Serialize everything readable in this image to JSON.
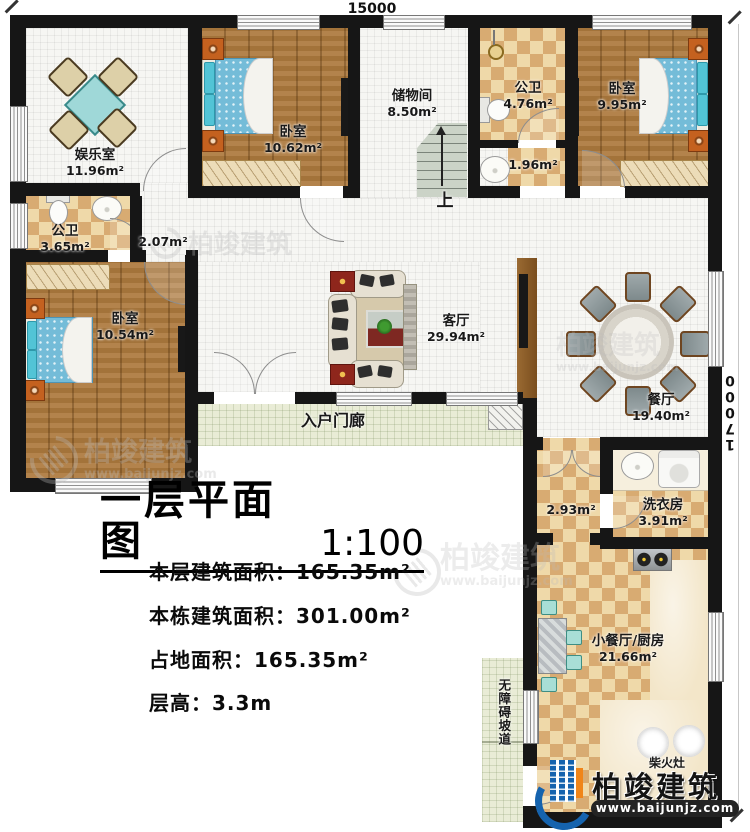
{
  "dimensions": {
    "top": "15000",
    "right": "17000"
  },
  "rooms": {
    "entertainment": {
      "name": "娱乐室",
      "area": "11.96m²"
    },
    "bedroom_a": {
      "name": "卧室",
      "area": "10.62m²"
    },
    "bath_left": {
      "name": "公卫",
      "area": "3.65m²"
    },
    "hall": {
      "area": "2.07m²"
    },
    "storage": {
      "name": "储物间",
      "area": "8.50m²"
    },
    "bath_top": {
      "name": "公卫",
      "area": "4.76m²"
    },
    "wash_nook": {
      "area": "1.96m²"
    },
    "bedroom_b": {
      "name": "卧室",
      "area": "9.95m²"
    },
    "bedroom_c": {
      "name": "卧室",
      "area": "10.54m²"
    },
    "living": {
      "name": "客厅",
      "area": "29.94m²"
    },
    "dining": {
      "name": "餐厅",
      "area": "19.40m²"
    },
    "porch": {
      "name": "入户门廊"
    },
    "corridor": {
      "area": "2.93m²"
    },
    "laundry": {
      "name": "洗衣房",
      "area": "3.91m²"
    },
    "kitchen": {
      "name": "小餐厅/厨房",
      "area": "21.66m²"
    },
    "ramp": {
      "name": "无障碍坡道"
    },
    "wood_stove": {
      "name": "柴火灶"
    },
    "stairs": {
      "direction": "上"
    }
  },
  "title_block": {
    "title": "一层平面图",
    "scale": "1:100",
    "stats": [
      {
        "label": "本层建筑面积：",
        "value": "165.35m²"
      },
      {
        "label": "本栋建筑面积：",
        "value": "301.00m²"
      },
      {
        "label": "占地面积：",
        "value": "165.35m²"
      },
      {
        "label": "层高：",
        "value": "3.3m"
      }
    ]
  },
  "watermark": {
    "brand": "柏竣建筑",
    "url": "www.baijunjz.com"
  },
  "logo": {
    "brand": "柏竣建筑",
    "url": "www.baijunjz.com"
  }
}
